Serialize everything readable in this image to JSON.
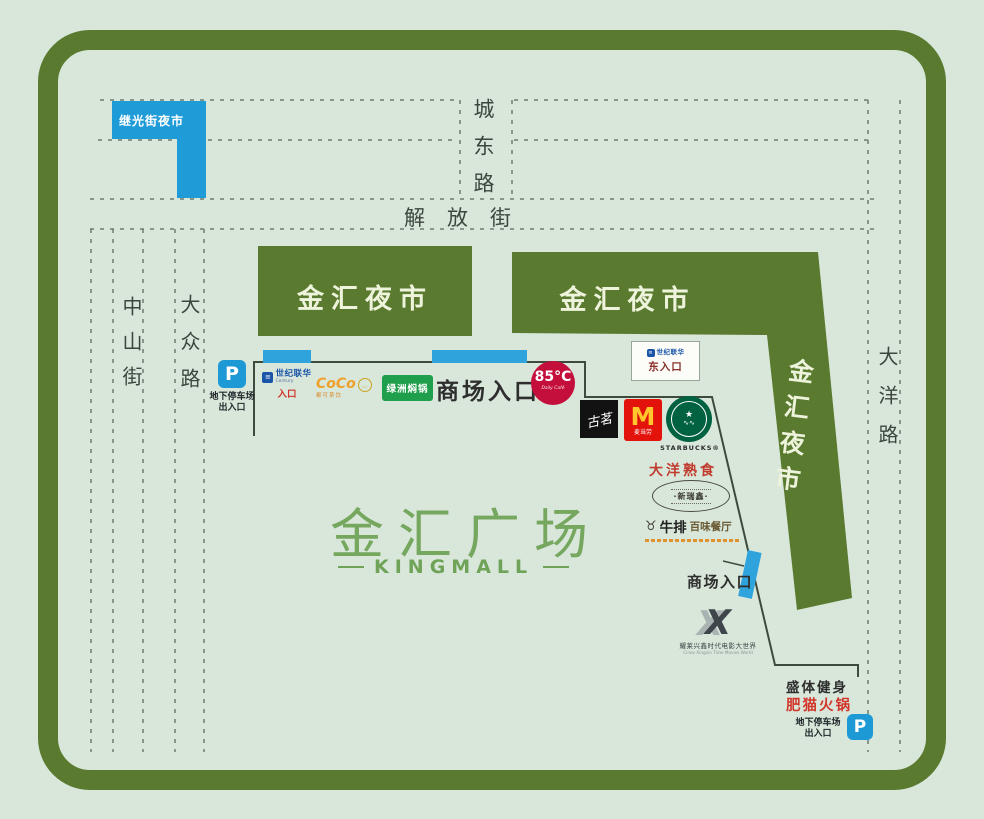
{
  "colors": {
    "frame_green": "#5a7a2f",
    "background": "#d9e7db",
    "market_blue": "#1f9cd8",
    "title_green": "#76a75f"
  },
  "title": {
    "zh": "金汇广场",
    "en": "KINGMALL"
  },
  "roads": {
    "chengdong": "城东路",
    "jiefang": "解放街",
    "zhongshan": "中山街",
    "dazhong": "大众路",
    "dayang": "大洋路"
  },
  "night_markets": {
    "jiguang": "继光街夜市",
    "jinhui_left": "金汇夜市",
    "jinhui_right": "金汇夜市",
    "jinhui_diagonal": "金汇夜市"
  },
  "entrances": {
    "mall_top": "商场入口",
    "mall_right": "商场入口",
    "east": "东入口"
  },
  "parking_west": {
    "p": "P",
    "line1": "地下停车场",
    "line2": "出入口"
  },
  "parking_south": {
    "p": "P",
    "line1": "地下停车场",
    "line2": "出入口"
  },
  "stores": {
    "century": {
      "icon": "≡",
      "name": "世纪联华",
      "en": "Century",
      "entrance": "入口"
    },
    "east_box_brand": "世纪联华",
    "coco": {
      "name": "CoCo",
      "sub": "都可茶饮",
      "face": "◡"
    },
    "lvzhou": {
      "name": "绿洲焖锅"
    },
    "bakery85": {
      "name": "85°C",
      "sub": "Daily Café"
    },
    "guming": {
      "name": "古茗"
    },
    "mcdonalds": {
      "m": "M",
      "name": "麦当劳"
    },
    "starbucks": {
      "star": "★",
      "wave": "∿∿",
      "label": "STARBUCKS®"
    },
    "dayang_deli": {
      "name": "大洋熟食"
    },
    "oval_restaurant": {
      "name": "·新瑞鑫·"
    },
    "steak": {
      "shield": "♉",
      "bold": "牛排",
      "rest": "百味餐厅"
    },
    "cinema": {
      "x": "X",
      "line1": "耀莱兴鑫时代电影大世界",
      "line2": "Cinex Xingxin Time Movies World"
    },
    "fitness": {
      "name": "盛体健身"
    },
    "hotpot": {
      "name": "肥猫火锅"
    }
  }
}
